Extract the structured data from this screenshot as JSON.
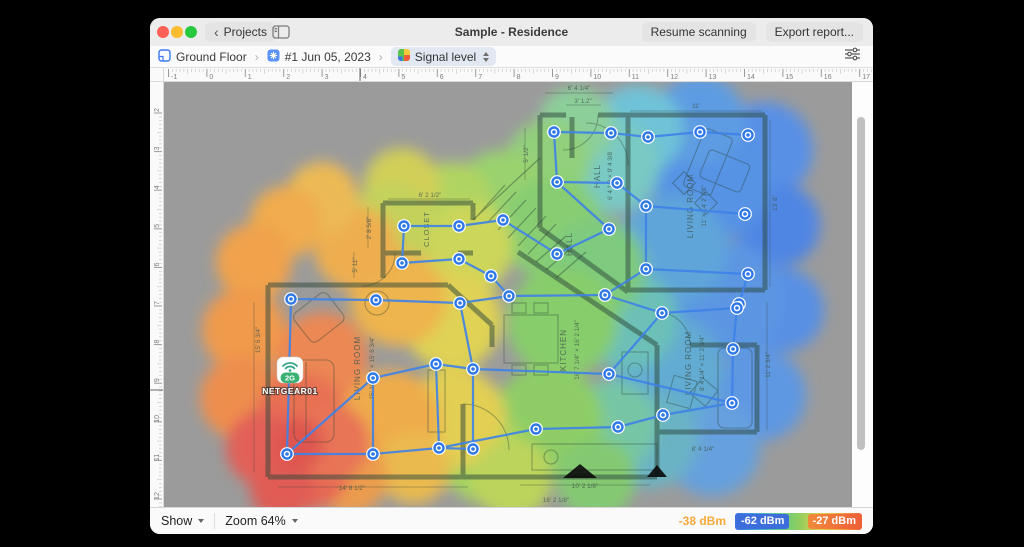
{
  "window": {
    "title": "Sample - Residence",
    "back_button": "Projects",
    "resume_button": "Resume scanning",
    "export_button": "Export report..."
  },
  "toolbar": {
    "breadcrumb": [
      {
        "label": "Ground Floor"
      },
      {
        "label": "#1 Jun 05, 2023"
      },
      {
        "label": "Signal level"
      }
    ]
  },
  "rulers": {
    "top": {
      "numbers": [
        -1,
        0,
        1,
        2,
        3,
        4,
        5,
        6,
        7,
        8,
        9,
        10,
        11,
        12,
        13,
        14,
        15,
        16,
        17
      ],
      "start_x": 168.5,
      "spacing": 38.4,
      "marker_x": 360
    },
    "left": {
      "numbers": [
        2,
        3,
        4,
        5,
        6,
        7,
        8,
        9,
        10,
        11,
        12
      ],
      "start_y": 113,
      "spacing": 38.6,
      "marker_y": 390
    }
  },
  "statusbar": {
    "show_label": "Show",
    "zoom_label": "Zoom 64%",
    "legend": {
      "cursor_value": "-38 dBm",
      "min_badge": "-62 dBm",
      "max_badge": "-27 dBm",
      "min_color": "#3d6cdb",
      "max_color": "#ee5f38",
      "gradient": [
        "#3f6fdd",
        "#49a7e0",
        "#5ec992",
        "#8fce5f",
        "#d9d14e",
        "#f2a93e",
        "#ee5f38"
      ]
    }
  },
  "access_point": {
    "name": "NETGEAR01",
    "band": "2G",
    "x": 290,
    "y": 370,
    "wifi_color": "#2aa483",
    "badge_color": "#3bb273"
  },
  "survey": {
    "point_color": "#2e78e8",
    "path_color": "#3f82e8",
    "points": [
      [
        554,
        132
      ],
      [
        611,
        133
      ],
      [
        648,
        137
      ],
      [
        700,
        132
      ],
      [
        748,
        135
      ],
      [
        557,
        182
      ],
      [
        617,
        183
      ],
      [
        646,
        206
      ],
      [
        745,
        214
      ],
      [
        609,
        229
      ],
      [
        557,
        254
      ],
      [
        646,
        269
      ],
      [
        748,
        274
      ],
      [
        605,
        295
      ],
      [
        739,
        304
      ],
      [
        404,
        226
      ],
      [
        459,
        226
      ],
      [
        503,
        220
      ],
      [
        402,
        263
      ],
      [
        459,
        259
      ],
      [
        491,
        276
      ],
      [
        291,
        299
      ],
      [
        376,
        300
      ],
      [
        460,
        303
      ],
      [
        509,
        296
      ],
      [
        662,
        313
      ],
      [
        737,
        308
      ],
      [
        733,
        349
      ],
      [
        436,
        364
      ],
      [
        473,
        369
      ],
      [
        373,
        378
      ],
      [
        609,
        374
      ],
      [
        536,
        429
      ],
      [
        663,
        415
      ],
      [
        732,
        403
      ],
      [
        618,
        427
      ],
      [
        287,
        454
      ],
      [
        373,
        454
      ],
      [
        439,
        448
      ],
      [
        473,
        449
      ]
    ],
    "edges": [
      [
        0,
        1
      ],
      [
        1,
        2
      ],
      [
        2,
        3
      ],
      [
        3,
        4
      ],
      [
        0,
        5
      ],
      [
        5,
        6
      ],
      [
        6,
        7
      ],
      [
        7,
        8
      ],
      [
        7,
        11
      ],
      [
        11,
        12
      ],
      [
        12,
        14
      ],
      [
        11,
        13
      ],
      [
        5,
        9
      ],
      [
        9,
        10
      ],
      [
        10,
        17
      ],
      [
        17,
        16
      ],
      [
        16,
        15
      ],
      [
        15,
        18
      ],
      [
        18,
        19
      ],
      [
        19,
        20
      ],
      [
        20,
        24
      ],
      [
        21,
        22
      ],
      [
        22,
        23
      ],
      [
        23,
        24
      ],
      [
        24,
        13
      ],
      [
        13,
        25
      ],
      [
        25,
        26
      ],
      [
        26,
        27
      ],
      [
        27,
        34
      ],
      [
        25,
        31
      ],
      [
        23,
        29
      ],
      [
        29,
        28
      ],
      [
        28,
        30
      ],
      [
        30,
        37
      ],
      [
        37,
        36
      ],
      [
        36,
        21
      ],
      [
        30,
        36
      ],
      [
        29,
        31
      ],
      [
        31,
        34
      ],
      [
        34,
        33
      ],
      [
        33,
        35
      ],
      [
        35,
        32
      ],
      [
        32,
        38
      ],
      [
        38,
        37
      ],
      [
        38,
        39
      ],
      [
        39,
        29
      ],
      [
        28,
        38
      ]
    ]
  },
  "heatmap": {
    "circles": [
      [
        765,
        150,
        48,
        "#5890e6"
      ],
      [
        778,
        225,
        42,
        "#4f86e4"
      ],
      [
        782,
        310,
        42,
        "#5890e4"
      ],
      [
        760,
        395,
        46,
        "#5f98e2"
      ],
      [
        712,
        448,
        48,
        "#66a0de"
      ],
      [
        722,
        300,
        60,
        "#5c96e2"
      ],
      [
        712,
        180,
        60,
        "#5793e4"
      ],
      [
        700,
        120,
        45,
        "#5d9ce2"
      ],
      [
        672,
        250,
        55,
        "#5fa5da"
      ],
      [
        668,
        370,
        55,
        "#62abd2"
      ],
      [
        650,
        440,
        48,
        "#6ab3c4"
      ],
      [
        638,
        130,
        45,
        "#6fc2d8"
      ],
      [
        612,
        165,
        48,
        "#79c9c4"
      ],
      [
        628,
        320,
        50,
        "#6cc0b8"
      ],
      [
        612,
        425,
        45,
        "#76c6a6"
      ],
      [
        576,
        125,
        38,
        "#8ccf9a"
      ],
      [
        548,
        162,
        42,
        "#92d07c"
      ],
      [
        502,
        198,
        48,
        "#9ad26e"
      ],
      [
        552,
        228,
        52,
        "#88cd72"
      ],
      [
        596,
        268,
        50,
        "#7eca7e"
      ],
      [
        562,
        322,
        55,
        "#88cd6c"
      ],
      [
        548,
        420,
        55,
        "#8ecd66"
      ],
      [
        596,
        478,
        40,
        "#84c972"
      ],
      [
        486,
        458,
        45,
        "#a6d360"
      ],
      [
        452,
        202,
        40,
        "#b0d462"
      ],
      [
        468,
        248,
        45,
        "#ccd65a"
      ],
      [
        452,
        320,
        50,
        "#dfd254"
      ],
      [
        456,
        418,
        50,
        "#e2cf52"
      ],
      [
        402,
        186,
        38,
        "#d2cf58"
      ],
      [
        392,
        224,
        42,
        "#c4d25c"
      ],
      [
        512,
        478,
        40,
        "#bcd45c"
      ],
      [
        398,
        298,
        48,
        "#eeb44e"
      ],
      [
        390,
        420,
        50,
        "#efac4c"
      ],
      [
        356,
        248,
        42,
        "#eeae50"
      ],
      [
        322,
        198,
        36,
        "#ecba54"
      ],
      [
        286,
        222,
        36,
        "#f0ac4e"
      ],
      [
        254,
        262,
        38,
        "#f1a24c"
      ],
      [
        244,
        330,
        42,
        "#f09a4c"
      ],
      [
        242,
        398,
        42,
        "#ee8e4e"
      ],
      [
        414,
        468,
        36,
        "#eaba50"
      ],
      [
        350,
        476,
        38,
        "#ec9c4e"
      ],
      [
        322,
        358,
        46,
        "#ec8852"
      ],
      [
        300,
        418,
        46,
        "#e87052"
      ],
      [
        308,
        468,
        42,
        "#e66854"
      ],
      [
        264,
        448,
        38,
        "#e26058"
      ],
      [
        282,
        488,
        32,
        "#e05c54"
      ],
      [
        332,
        442,
        38,
        "#e87456"
      ],
      [
        298,
        444,
        26,
        "#de5650"
      ]
    ]
  },
  "floorplan": {
    "labels": [
      {
        "t": "CLOSET",
        "x": 429,
        "y": 229,
        "r": -90,
        "s": 7.5
      },
      {
        "t": "HALL",
        "x": 600,
        "y": 176,
        "r": -90,
        "s": 8
      },
      {
        "t": "6' 4 1/2 × 9' 4 3/8",
        "x": 612,
        "y": 176,
        "r": -90,
        "s": 6.3
      },
      {
        "t": "HALL",
        "x": 572,
        "y": 244,
        "r": -90,
        "s": 8
      },
      {
        "t": "LIVING ROOM",
        "x": 693,
        "y": 206,
        "r": -90,
        "s": 8
      },
      {
        "t": "11' × 14' 2 7/8\"",
        "x": 706,
        "y": 206,
        "r": -90,
        "s": 6.3
      },
      {
        "t": "LIVING ROOM",
        "x": 360,
        "y": 368,
        "r": -90,
        "s": 8
      },
      {
        "t": "15' 10 3/4\" × 15' 6 3/4\"",
        "x": 374,
        "y": 368,
        "r": -90,
        "s": 6.3
      },
      {
        "t": "KITCHEN",
        "x": 566,
        "y": 350,
        "r": -90,
        "s": 8
      },
      {
        "t": "16' 7 1/4\" × 16' 2 1/4\"",
        "x": 579,
        "y": 350,
        "r": -90,
        "s": 6.3
      },
      {
        "t": "LIVING ROOM",
        "x": 691,
        "y": 363,
        "r": -90,
        "s": 8
      },
      {
        "t": "8' 4 1/4\" × 11' 2 3/4\"",
        "x": 704,
        "y": 363,
        "r": -90,
        "s": 6.3
      },
      {
        "t": "6' 2 1/2\"",
        "x": 430,
        "y": 197,
        "r": 0,
        "s": 6.3
      },
      {
        "t": "2' 8 5/8\"",
        "x": 371,
        "y": 228,
        "r": -90,
        "s": 6.3
      },
      {
        "t": "5' 11\"",
        "x": 357,
        "y": 265,
        "r": -90,
        "s": 6.3
      },
      {
        "t": "6' 4 1/4\"",
        "x": 579,
        "y": 90,
        "r": 0,
        "s": 6.3
      },
      {
        "t": "3' 1.2\"",
        "x": 583,
        "y": 103,
        "r": 0,
        "s": 6.3
      },
      {
        "t": "5' 1/2\"",
        "x": 528,
        "y": 154,
        "r": -90,
        "s": 6.3
      },
      {
        "t": "11'",
        "x": 696,
        "y": 108,
        "r": 0,
        "s": 6.3
      },
      {
        "t": "13' 8\"",
        "x": 777,
        "y": 203,
        "r": -90,
        "s": 6.3
      },
      {
        "t": "15' 6 3/4\"",
        "x": 260,
        "y": 340,
        "r": -90,
        "s": 6.3
      },
      {
        "t": "14' 8 1/2\"",
        "x": 352,
        "y": 490,
        "r": 0,
        "s": 6.3
      },
      {
        "t": "10' 2 1/8\"",
        "x": 585,
        "y": 488,
        "r": 0,
        "s": 6.3
      },
      {
        "t": "16' 2 1/8\"",
        "x": 556,
        "y": 502,
        "r": 0,
        "s": 6.3
      },
      {
        "t": "8' 4 1/4\"",
        "x": 703,
        "y": 451,
        "r": 0,
        "s": 6.3
      },
      {
        "t": "11' 2 3/4\"",
        "x": 770,
        "y": 365,
        "r": -90,
        "s": 6.3
      }
    ]
  }
}
